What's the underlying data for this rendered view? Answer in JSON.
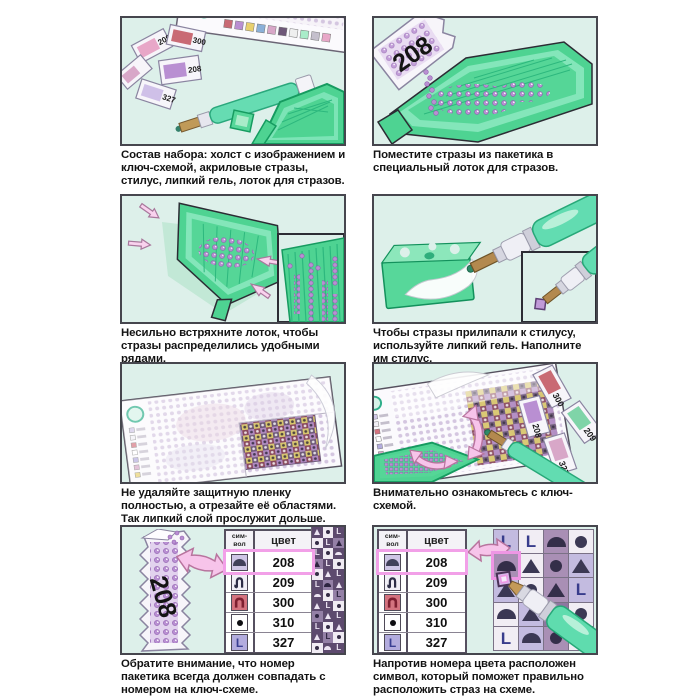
{
  "colors": {
    "panel_bg": "#ddf0ea",
    "panel_border": "#46464e",
    "tray_green": "#4ed392",
    "tray_edge": "#169b60",
    "stylus_green": "#63dcb0",
    "bead_purple": "#b98fd2",
    "arrow_pink": "#f7c4ea",
    "highlight_pink": "#f2a0e8",
    "caption_color": "#131313"
  },
  "steps": [
    {
      "caption": "Состав набора: холст с изображением и ключ-схемой, акриловые стразы, стилус, липкий гель, лоток для стразов."
    },
    {
      "caption": "Поместите стразы из пакетика в специальный лоток для стразов."
    },
    {
      "caption": "Несильно встряхните лоток, чтобы стразы распределились удобными рядами."
    },
    {
      "caption": "Чтобы стразы прилипали к стилусу, используйте липкий гель. Наполните им стилус."
    },
    {
      "caption": "Не удаляйте защитную пленку полностью, а отрезайте её областями. Так липкий слой прослужит дольше."
    },
    {
      "caption": "Внимательно ознакомьтесь с ключ-схемой."
    },
    {
      "caption": "Обратите внимание, что номер пакетика всегда должен совпадать с номером на ключ-схеме."
    },
    {
      "caption": "Напротив номера цвета расположен символ, который поможет правильно расположить страз на схеме."
    }
  ],
  "packets": {
    "step1": [
      "209",
      "300",
      "208",
      "327"
    ],
    "step2": "208",
    "step6": [
      "300",
      "208",
      "209",
      "327"
    ],
    "step7": "208"
  },
  "color_table": {
    "header_symbol": [
      "сим-",
      "вол"
    ],
    "header_color": "цвет",
    "letter_glyph": "L",
    "rows": [
      {
        "symbol": "dome",
        "code": "208",
        "highlighted": true
      },
      {
        "symbol": "hook",
        "code": "209",
        "highlighted": false
      },
      {
        "symbol": "arch",
        "code": "300",
        "highlighted": false
      },
      {
        "symbol": "dot",
        "code": "310",
        "highlighted": false
      },
      {
        "symbol": "letter-L",
        "code": "327",
        "highlighted": false
      }
    ]
  },
  "pattern_grid": {
    "highlight_index": 4,
    "cells": [
      "L:lav",
      "L:white",
      "dome:mauve",
      "dot:white",
      "dome:mauve",
      "tri:white",
      "dot:mauve",
      "tri:lav",
      "tri:lav",
      "dot:white",
      "tri:mauve",
      "L:lav",
      "dome:white",
      "tri:lav",
      "L:plum",
      "dot:white",
      "L:white",
      "dome:lav",
      "dot:mauve",
      "tri:white"
    ]
  },
  "strip_cells": [
    "tri:dark",
    "dot:light",
    "L:dark",
    "dot:light",
    "L:dark",
    "tri:mid",
    "L:dark",
    "dot:light",
    "dome:dark",
    "tri:mid",
    "L:dark",
    "dot:light",
    "dot:light",
    "tri:dark",
    "L:dark",
    "L:dark",
    "dome:mid",
    "tri:dark",
    "dome:dark",
    "dot:light",
    "L:mid",
    "tri:dark",
    "L:dark",
    "dot:light",
    "dot:mid",
    "tri:dark",
    "L:dark",
    "L:dark",
    "dot:light",
    "tri:dark",
    "tri:dark",
    "L:mid",
    "dot:light",
    "dot:light",
    "dome:dark",
    "L:dark"
  ]
}
